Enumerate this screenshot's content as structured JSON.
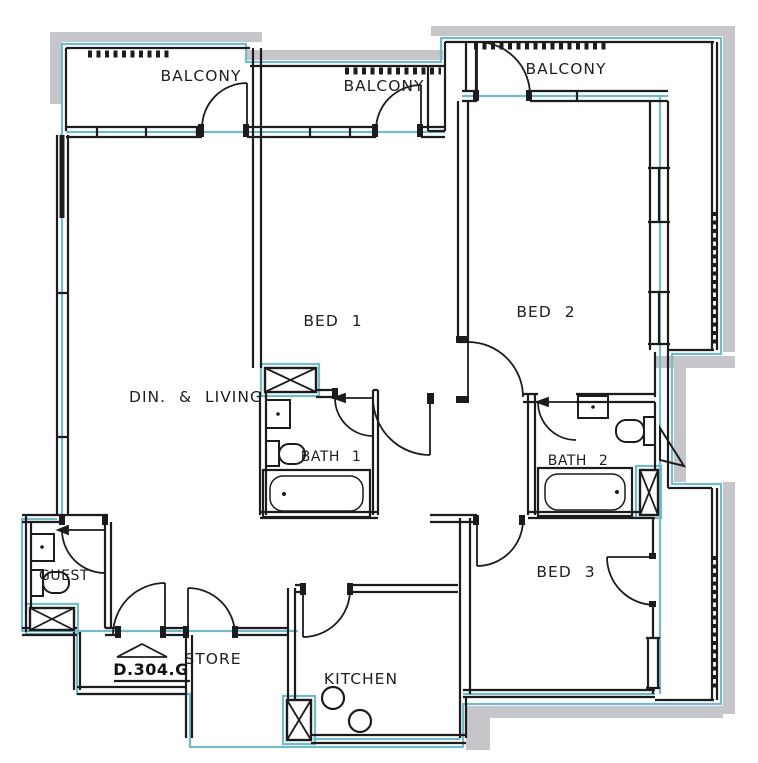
{
  "title": "Apartment floor plan",
  "colors": {
    "wall": "#1c1c1c",
    "accent": "#74bac9",
    "shadow": "#c6c6ca",
    "background": "#ffffff"
  },
  "rooms": {
    "balcony1": "BALCONY",
    "balcony2": "BALCONY",
    "balcony3": "BALCONY",
    "bed1": "BED 1",
    "bed2": "BED 2",
    "bed3": "BED 3",
    "dining_living": "DIN. & LIVING",
    "bath1": "BATH 1",
    "bath2": "BATH 2",
    "guest": "GUEST",
    "store": "STORE",
    "kitchen": "KITCHEN"
  },
  "entrance": {
    "label": "D.304.G"
  }
}
